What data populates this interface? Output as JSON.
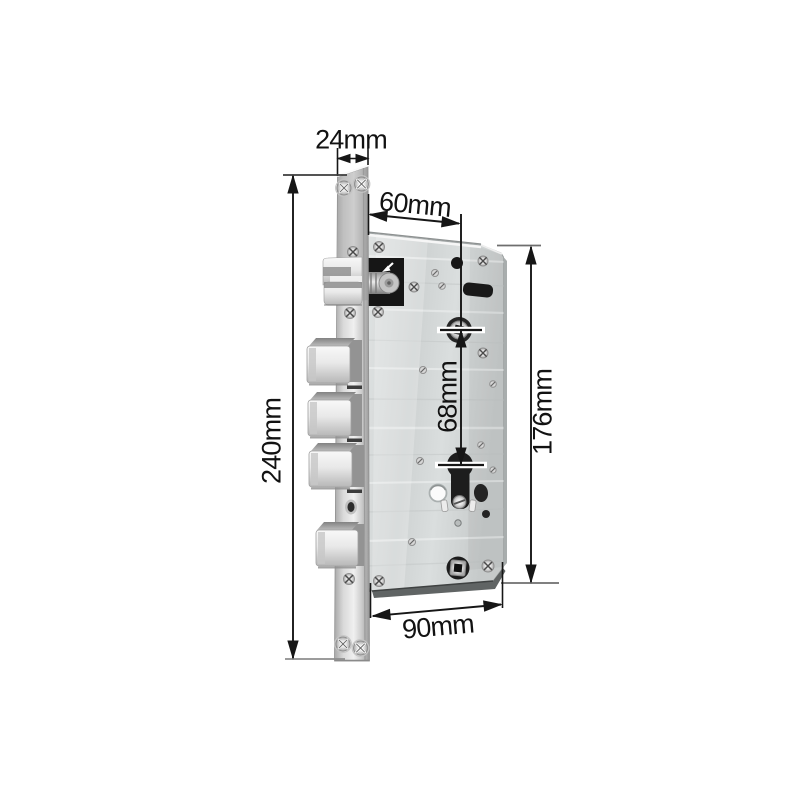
{
  "diagram": {
    "subject": "mortise lock body dimension drawing",
    "style": {
      "background": "#ffffff",
      "dimension_line_color": "#161616",
      "metal_light": "#f0f0f0",
      "metal_mid": "#ced2d2",
      "metal_dark": "#8d9191",
      "hole_color": "#1c1c1c"
    },
    "labels": {
      "faceplate_width": "24mm",
      "backset": "60mm",
      "handle_to_cylinder": "68mm",
      "faceplate_height": "240mm",
      "body_height": "176mm",
      "body_width": "90mm"
    }
  }
}
